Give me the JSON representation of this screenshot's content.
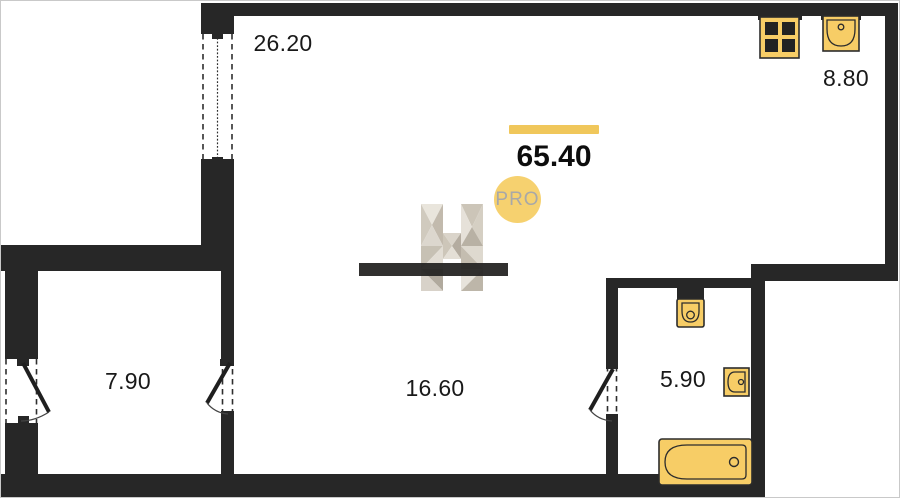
{
  "labels": {
    "total_area": "65.40",
    "living_area": "16.60",
    "kitchen_area": "8.80",
    "bedroom_area": "7.90",
    "bathroom_area": "5.90",
    "balcony_window": "26.20",
    "watermark_pro": "PRO"
  },
  "colors": {
    "wall": "#272727",
    "fixture_fill": "#F7CD66",
    "fixture_stroke": "#2c2c2c",
    "accent_bar": "#F0C75B",
    "pro_badge_fill": "#F6D16F",
    "pro_badge_text": "#A8A8A8",
    "label_text": "#191919"
  }
}
